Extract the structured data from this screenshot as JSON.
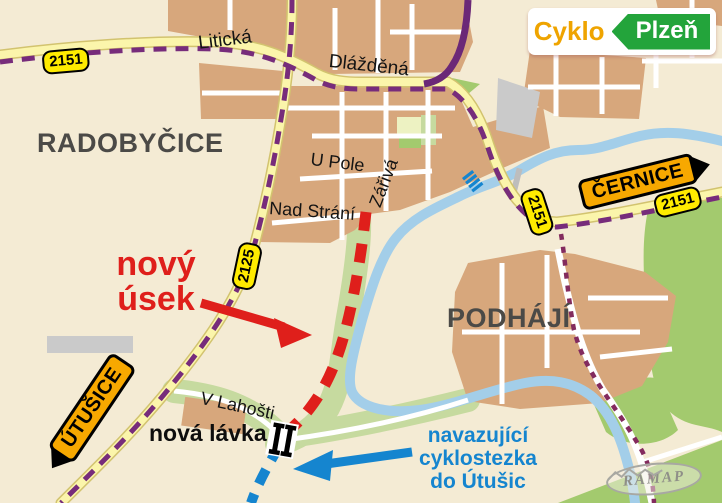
{
  "colors": {
    "bg": "#F4EBD4",
    "tan": "#D7A77C",
    "road-fill": "#FBF5AB",
    "road-casing": "#D2C36F",
    "street": "#FFFFFF",
    "river": "#A3CEE9",
    "green": "#A3CA6E",
    "green-light": "#C6DA9F",
    "field": "#EDF2C2",
    "gray": "#CACACA",
    "purple": "#772C7B",
    "purple-solid": "#6B2877",
    "wine": "#832B5E",
    "red": "#DF1F1B",
    "blue": "#1585CF",
    "badge": "#FFEB00",
    "amber": "#F7A800",
    "logo-green": "#23A43B",
    "logo-orange": "#EFA400",
    "ink": "#4B4A47"
  },
  "logo": {
    "cyklo": "Cyklo",
    "plzen": "Plzeň"
  },
  "areas": {
    "radobycice": "RADOBYČICE",
    "podhaji": "PODHÁJÍ"
  },
  "streets": {
    "liticka": "Litická",
    "dlazdena": "Dlážděná",
    "u_pole": "U Pole",
    "zariva": "Zářivá",
    "nad_strani": "Nad Strání",
    "v_lahosti": "V Lahošti"
  },
  "badges": {
    "left_2151": "2151",
    "river_2151": "2151",
    "right_2151": "2151",
    "road_2125": "2125"
  },
  "signs": {
    "cernice": "ČERNICE",
    "utusice": "ÚTUŠICE"
  },
  "annotations": {
    "new_section": {
      "line1": "nový",
      "line2": "úsek"
    },
    "new_footbridge": "nová lávka",
    "connecting_path": {
      "line1": "navazující",
      "line2": "cyklostezka",
      "line3": "do Útušic"
    }
  },
  "watermark": "RAMAP"
}
